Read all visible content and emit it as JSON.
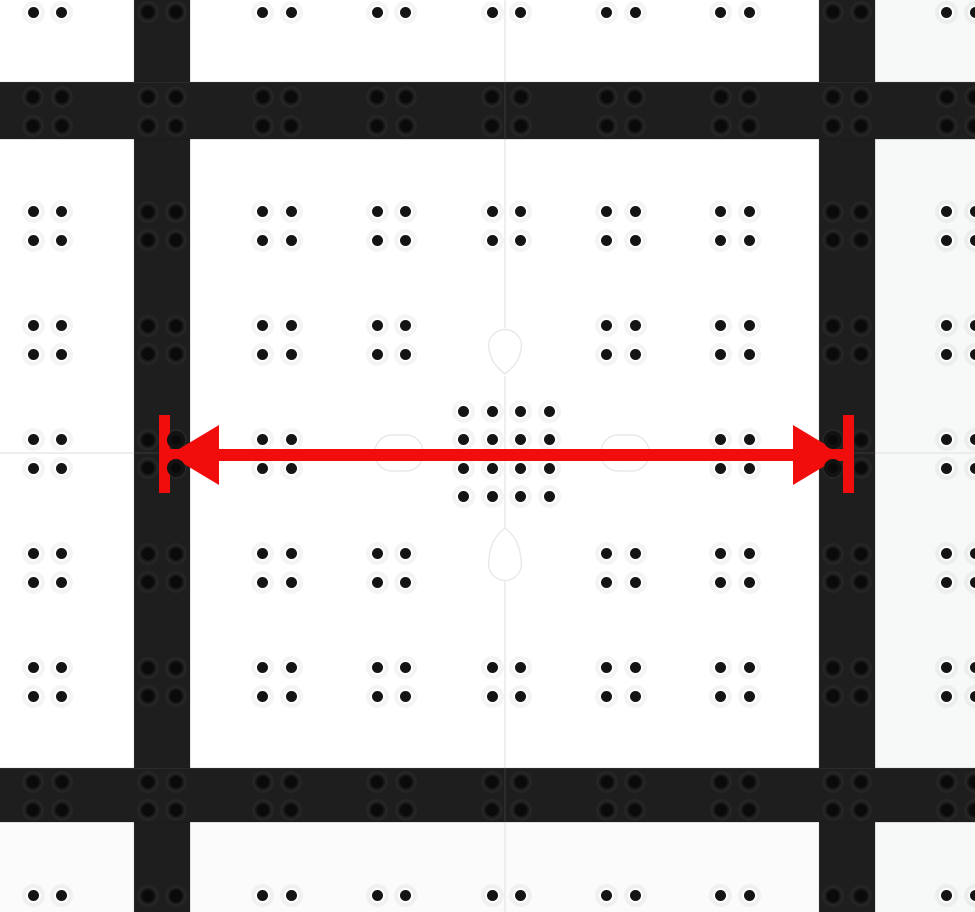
{
  "scene": {
    "width": 975,
    "height": 912,
    "colors": {
      "tile": "#ffffff",
      "tile_right": "#f7f8f8",
      "tile_bottom": "#fbfbfb",
      "band": "#1e1e1e",
      "band_dot": "#0a0a0a",
      "dot": "#141414",
      "seam": "#e8e8e8",
      "red": "#f20d0d"
    },
    "shade_regions": [
      {
        "name": "tile-shade-bottom",
        "x": 0,
        "y": 822,
        "w": 975,
        "h": 90,
        "color": "#fbfbfb"
      },
      {
        "name": "tile-shade-right",
        "x": 875,
        "y": 0,
        "w": 100,
        "h": 912,
        "color": "#f7f8f8"
      }
    ],
    "seams": {
      "vertical_x": 505,
      "horizontal_y": 453,
      "paths": [
        "M505 0 V328",
        "M505 374 C498 368 490 362 488.5 346 A16.5 16.5 0 1 1 521.5 346 C520 362 512 368 505 374 Z",
        "M505 376 V528",
        "M505 528 C498 534 490 540 488.5 564 A16.5 16.5 0 1 0 521.5 564 C520 540 512 534 505 528 Z",
        "M505 581 V768",
        "M505 822 V912",
        "M0 453 H975"
      ],
      "knob_rects": [
        {
          "x": 375,
          "y": 435,
          "w": 48,
          "h": 36,
          "r": 17
        },
        {
          "x": 601,
          "y": 435,
          "w": 48,
          "h": 36,
          "r": 17
        }
      ]
    },
    "bands": {
      "vertical": [
        {
          "name": "dark-rail-vertical-left",
          "x": 134,
          "w": 56
        },
        {
          "name": "dark-rail-vertical-right",
          "x": 819,
          "w": 56
        }
      ],
      "horizontal": [
        {
          "name": "dark-rail-horizontal-top",
          "y": 82,
          "h": 57
        },
        {
          "name": "dark-rail-horizontal-bottom",
          "y": 768,
          "h": 54
        }
      ]
    },
    "grid": {
      "cluster_cols_x": [
        47.5,
        162,
        277,
        391.5,
        506.5,
        621,
        735,
        847,
        961
      ],
      "cluster_rows_y": [
        -2,
        111.5,
        226,
        340,
        454,
        568,
        682,
        796,
        910
      ],
      "dot_offset": 14.25,
      "dot_diameter_white": 11,
      "dot_diameter_band": 12,
      "skip_cells": [
        [
          4,
          3
        ],
        [
          3,
          4
        ],
        [
          4,
          4
        ],
        [
          5,
          4
        ],
        [
          4,
          5
        ]
      ],
      "big_cluster": {
        "cx": 506.5,
        "cy": 454,
        "offsets": [
          -42.75,
          -14.25,
          14.25,
          42.75
        ]
      }
    },
    "annotation": {
      "kind": "double-headed-measurement-arrow",
      "color": "#f20d0d",
      "shaft": {
        "x1": 169,
        "x2": 843,
        "y": 449,
        "h": 12
      },
      "heads": [
        {
          "side": "left",
          "tip_x": 169,
          "top_y": 425
        },
        {
          "side": "right",
          "tip_x": 843,
          "top_y": 425
        }
      ],
      "ticks": [
        {
          "name": "measure-tick-left",
          "x": 158.5,
          "y": 415,
          "w": 11,
          "h": 78
        },
        {
          "name": "measure-tick-right",
          "x": 842.5,
          "y": 415,
          "w": 11,
          "h": 78
        }
      ],
      "ring_dots": [
        {
          "x": 176.25,
          "y": 439.75
        },
        {
          "x": 176.25,
          "y": 468.25
        },
        {
          "x": 832.75,
          "y": 439.75
        },
        {
          "x": 832.75,
          "y": 468.25
        }
      ],
      "ring_dot_outer": 18
    }
  }
}
